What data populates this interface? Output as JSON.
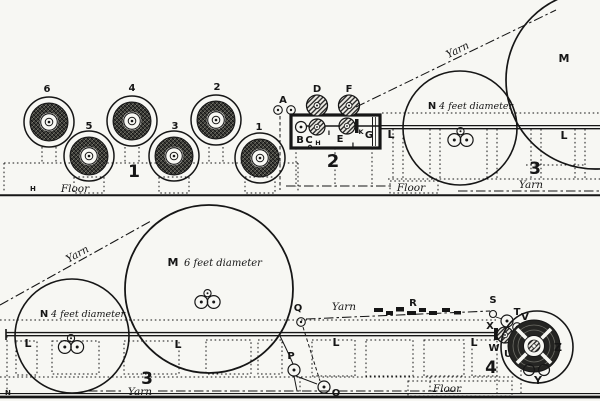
{
  "colors": {
    "paper": "#f7f7f3",
    "ink": "#161616"
  },
  "top": {
    "creel": {
      "number": "1",
      "spools": [
        "6",
        "5",
        "4",
        "3",
        "2",
        "1"
      ],
      "floor": "Floor",
      "mark": "H"
    },
    "machine": {
      "number": "2",
      "labels": {
        "A": "A",
        "B": "B",
        "C": "C",
        "D": "D",
        "E": "E",
        "F": "F",
        "G": "G",
        "H": "H",
        "I": "I",
        "J": "J",
        "K": "K"
      },
      "rail_label": "L"
    },
    "drums": {
      "M": "M",
      "N": "N",
      "n_note": "4 feet diameter"
    },
    "yarn_diagonal": "Yarn",
    "right": {
      "number": "3",
      "rail_label": "L",
      "floor": "Floor",
      "yarn": "Yarn"
    }
  },
  "bottom": {
    "yarn_diagonal": "Yarn",
    "drums": {
      "M": "M",
      "m_note": "6 feet diameter",
      "N": "N",
      "n_note": "4 feet diameter"
    },
    "rail": {
      "number": "3",
      "labels": [
        "L",
        "L",
        "L",
        "L"
      ],
      "yarn_floor": "Yarn",
      "mark": "N"
    },
    "guides": {
      "P": "P",
      "O": "O",
      "Q": "Q",
      "R": "R",
      "S": "S",
      "T": "T",
      "U": "U",
      "V": "V",
      "W": "W",
      "X": "X",
      "Y": "Y",
      "Z": "Z",
      "yarn": "Yarn"
    },
    "winder": {
      "number": "4"
    },
    "floor": "Floor"
  }
}
